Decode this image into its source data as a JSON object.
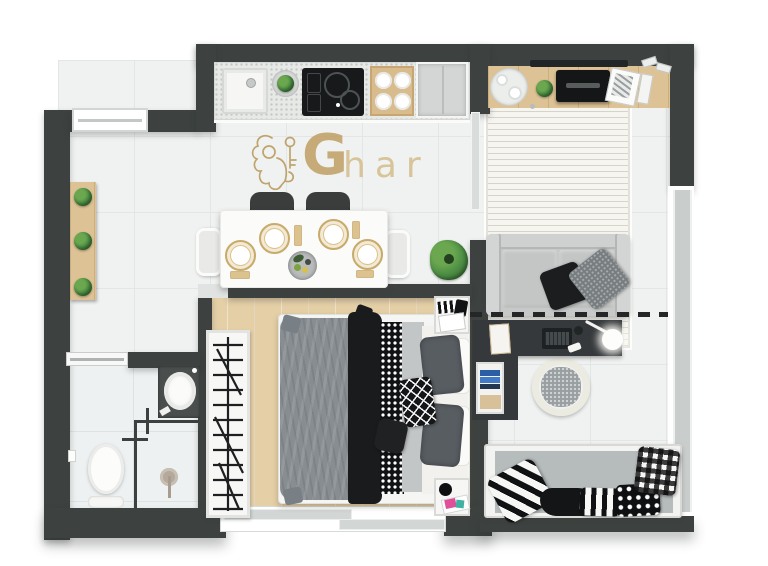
{
  "watermark": {
    "letter_g": "G",
    "letters_rest": "har",
    "emblem": "lion-with-key"
  },
  "palette": {
    "wall": "#3d4240",
    "tile_floor": "#f0f2f1",
    "wood_floor": "#e5cfa7",
    "bath_marble": "#eef1f1",
    "counter_speckle": "#e7e9e6",
    "console_wood": "#dcc294",
    "logo_gold": "#bf9f63",
    "sofa_gray": "#c7c9c8",
    "daybed_mattress": "#b6bbbc",
    "desk_black": "#36393b",
    "duvet_gray": "#878d91",
    "plant_green": "#4e8f45",
    "accent_pink": "#e04f9a",
    "book_blue": "#3f79c8"
  }
}
